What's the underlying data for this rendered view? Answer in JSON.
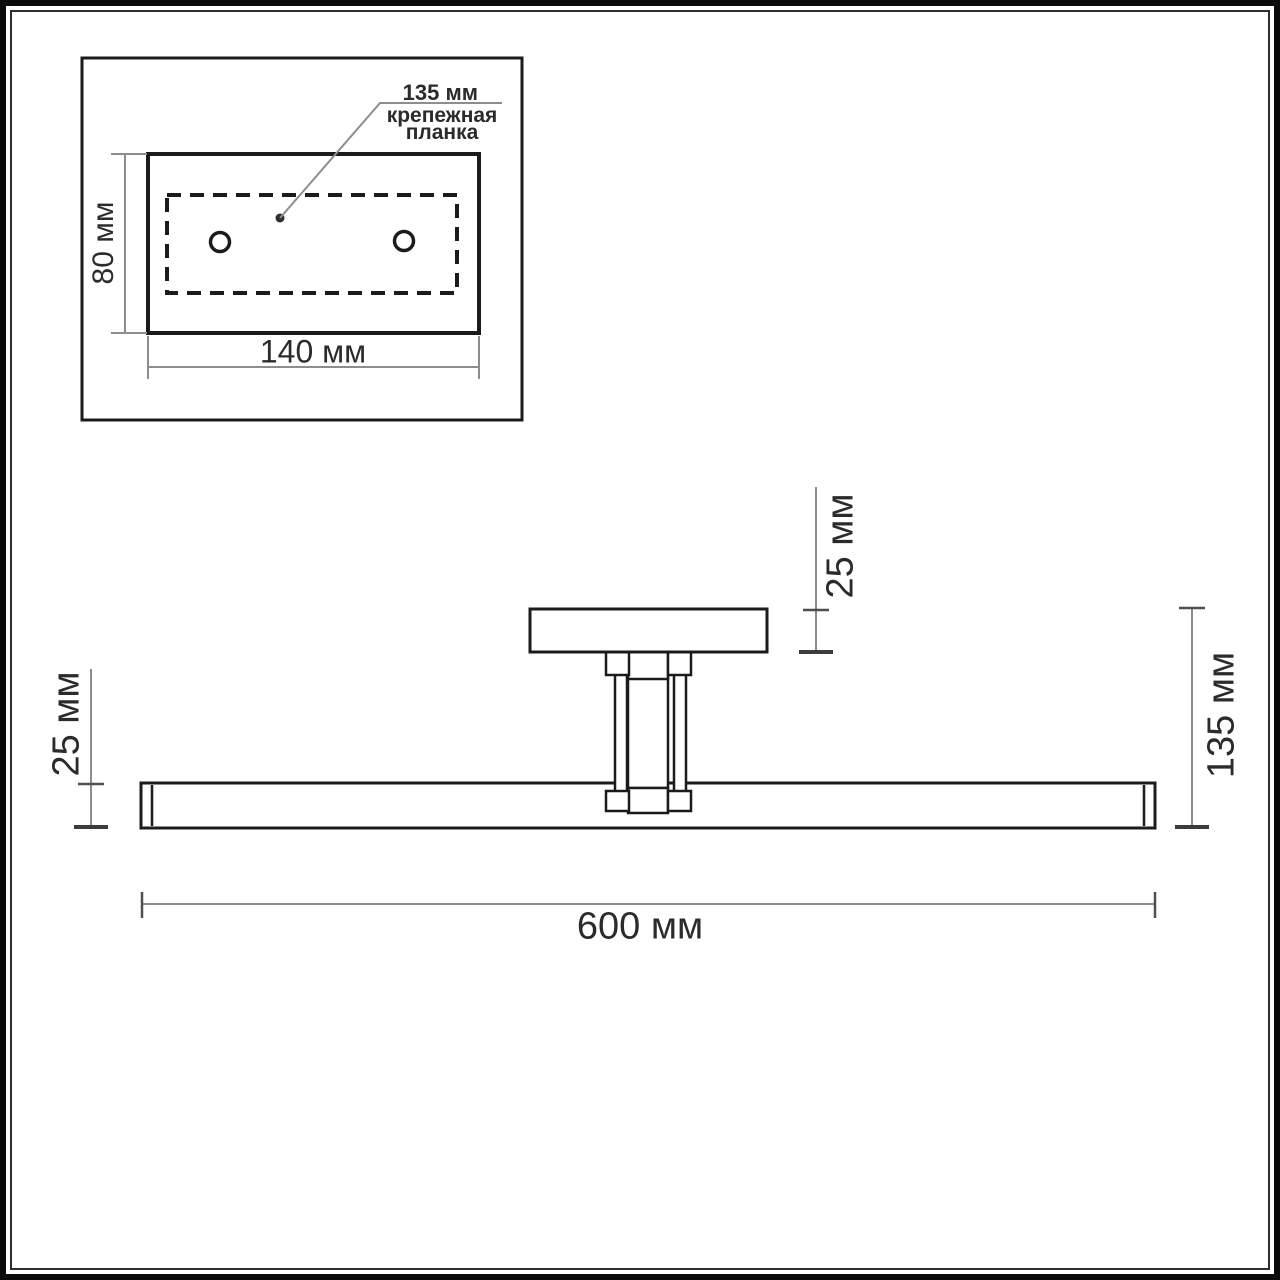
{
  "inset_view": {
    "callout_value": "135 мм",
    "callout_name_line1": "крепежная",
    "callout_name_line2": "планка",
    "height_label": "80 мм",
    "width_label": "140 мм"
  },
  "main_view": {
    "plate_thickness_label": "25 мм",
    "bar_thickness_label": "25 мм",
    "overall_height_label": "135 мм",
    "overall_length_label": "600 мм"
  },
  "colors": {
    "background": "#ffffff",
    "frame": "#0a0a0a",
    "object_line": "#1b1b1b",
    "dimension_line": "#8d8d8d",
    "tick_line": "#4f4f4f",
    "text": "#2b2b2b"
  }
}
